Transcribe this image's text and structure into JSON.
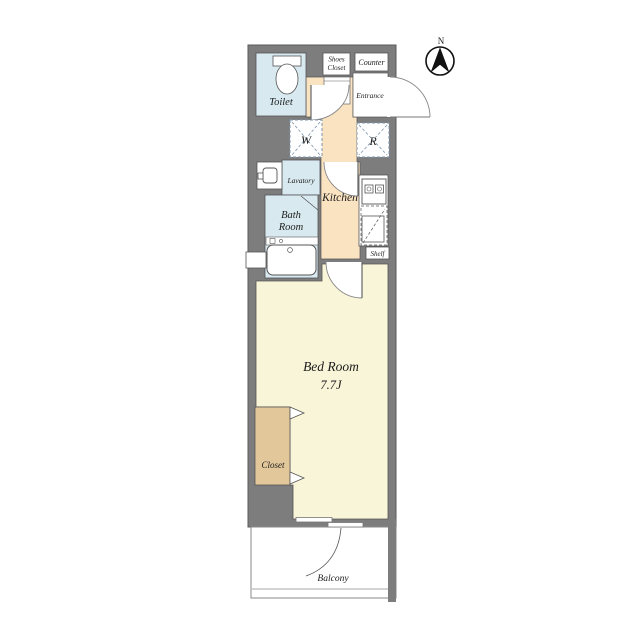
{
  "compass": {
    "north": "N"
  },
  "labels": {
    "toilet": "Toilet",
    "shoes_closet_line1": "Shoes",
    "shoes_closet_line2": "Closet",
    "counter": "Counter",
    "entrance": "Entrance",
    "washer_symbol": "W",
    "refrigerator_symbol": "R",
    "lavatory": "Lavatory",
    "kitchen": "Kitchen",
    "bath_line1": "Bath",
    "bath_line2": "Room",
    "shelf": "Shelf",
    "bedroom": "Bed Room",
    "bedroom_size": "7.7J",
    "closet": "Closet",
    "balcony": "Balcony"
  },
  "colors": {
    "wall": "#7d7d7d",
    "wet_room": "#d8eaf0",
    "hall_kitchen": "#f9e3c1",
    "bedroom": "#f9f5d8",
    "closet": "#e2c79b",
    "fixture_dash": "#7e95ac",
    "outline": "#555555",
    "thin_line": "#8a8a8a"
  }
}
